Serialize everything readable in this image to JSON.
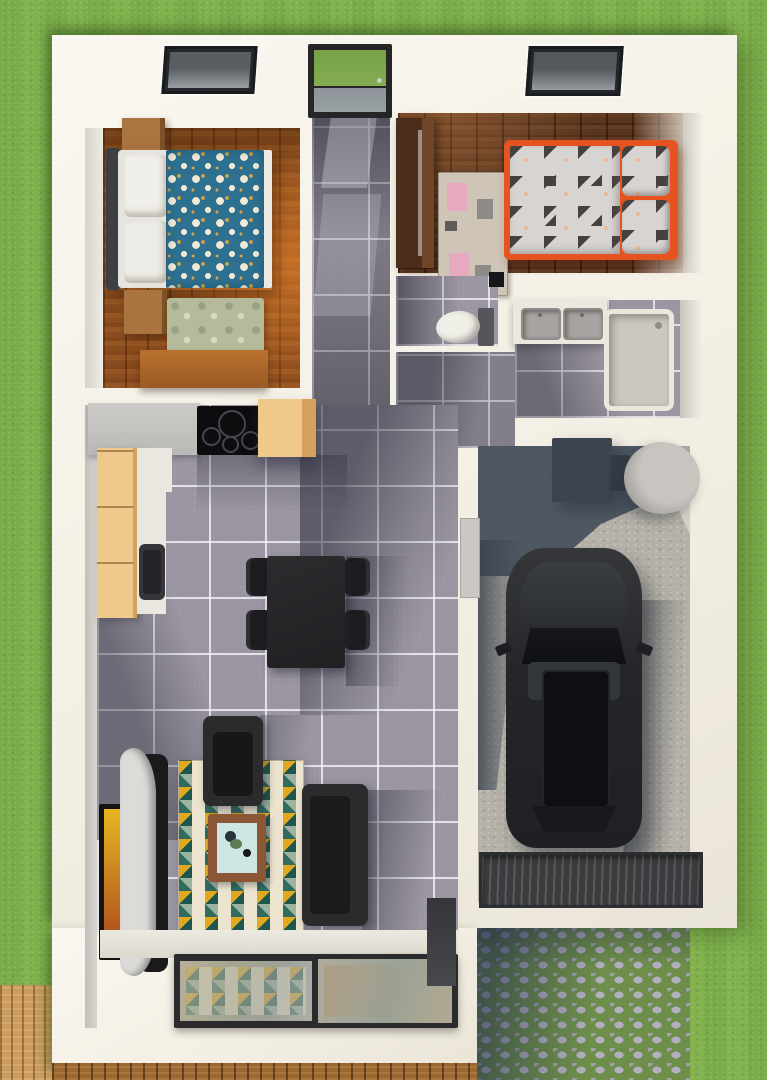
{
  "scene": {
    "type": "architectural-3d-floorplan-top-view",
    "house": {
      "rooms": [
        {
          "name": "master-bedroom",
          "floor": "warm-wood",
          "skylight": true,
          "furniture": [
            "double-bed",
            "nightstand",
            "nightstand",
            "green-area-rug",
            "desk"
          ]
        },
        {
          "name": "entry-hall",
          "floor": "gray-tile",
          "front_door_glazed": true,
          "furniture": []
        },
        {
          "name": "kids-bedroom",
          "floor": "dark-wood",
          "skylight": true,
          "furniture": [
            "single-bed-orange-frame",
            "wardrobe",
            "play-rug"
          ]
        },
        {
          "name": "wc",
          "floor": "gray-tile",
          "furniture": [
            "toilet",
            "wall-vent"
          ]
        },
        {
          "name": "bathroom",
          "floor": "gray-tile",
          "furniture": [
            "double-sink-vanity",
            "shower-tray"
          ]
        },
        {
          "name": "kitchen",
          "floor": "gray-tile",
          "furniture": [
            "worktop",
            "induction-cooktop",
            "tall-cabinet",
            "base-cabinets",
            "kitchen-sink"
          ]
        },
        {
          "name": "dining-area",
          "floor": "gray-tile",
          "furniture": [
            "dining-table",
            "chair",
            "chair",
            "chair",
            "chair"
          ]
        },
        {
          "name": "living-room",
          "floor": "gray-tile",
          "furniture": [
            "sofa",
            "armchair",
            "coffee-table",
            "tv-picture",
            "curved-media-console",
            "triangle-pattern-rug",
            "sliding-glass-door"
          ]
        },
        {
          "name": "garage",
          "floor": "concrete",
          "furniture": [
            "car-black",
            "water-tank-cylinder",
            "utility-box",
            "service-door",
            "garage-door-mat"
          ]
        }
      ]
    },
    "exterior": [
      "lawn",
      "cobblestone-driveway",
      "wood-deck-bottom",
      "wood-deck-corner"
    ]
  },
  "colors": {
    "grass": "#81b24d",
    "wall": "#f5f1e7",
    "tile": "#9a95a0",
    "woodMaster": "#8a4c1e",
    "woodKids": "#5a3520",
    "wardrobe": "#4a2d1a",
    "cabinetTan": "#efc98c",
    "cabinetTanSide": "#d5a15c",
    "counterGray": "#c6c4c0",
    "counterWhite": "#e9e7e0",
    "duvetTeal": "#2e7090",
    "flowerCream": "#f1ead6",
    "flowerGold": "#dfa43c",
    "rugGreen": "#b5bb9a",
    "bedOrange": "#e5531f",
    "bedding": "#d8d4d2",
    "beddingDark": "#45413f",
    "beddingPeach": "#f0b48e",
    "kidsRug": "#cfc5b7",
    "kidsRugPink": "#e6a9bf",
    "kidsRugGray": "#8e8a88",
    "rugCream": "#ece4cf",
    "rugTeal": "#2f6b5e",
    "rugTealDeep": "#1e574d",
    "rugGold": "#e2a81f",
    "rugSage": "#9db3a2",
    "furnitureDark": "#2b2b2d",
    "furnitureDarker": "#1a1a1c",
    "coffeeWood": "#8a5634",
    "coffeeTop": "#cde5e3",
    "concrete": "#b5b1a8",
    "garageShadow": "#414b58",
    "carBody": "#26282b",
    "carGlass": "#0d0f12",
    "matDark": "#3a3c3e",
    "cobble": "#b2b0ba",
    "cobbleJoint": "#6e8f4a",
    "deck": "#9c6631",
    "deckLight": "#cb9c5e",
    "doorFrame": "#262626",
    "doorGlassGreen": "#76a148",
    "doorGlassGray": "#99a0a4",
    "vanity": "#ebe8df",
    "sink": "#a7a4a1",
    "showerTray": "#cbc8c2",
    "toilet": "#efeee7",
    "tank": "#bcb8b4",
    "utilityBox": "#3c444e",
    "consoleWhite": "#dcdbd8",
    "tvGold": "#e6b722",
    "tvRust": "#a8431c"
  }
}
